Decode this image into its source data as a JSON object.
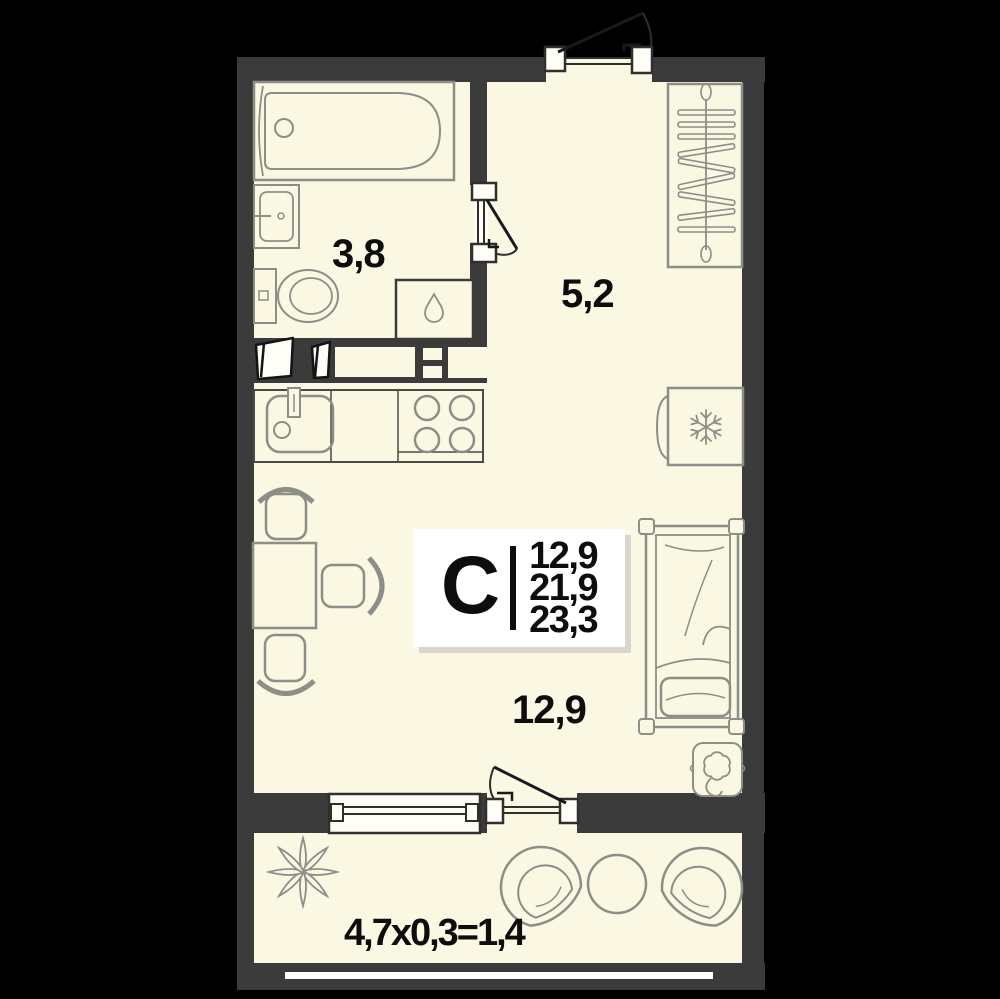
{
  "plan": {
    "card": {
      "type_letter": "С",
      "living_area": "12,9",
      "area_without_balcony": "21,9",
      "total_area": "23,3"
    },
    "room_areas": {
      "bathroom": "3,8",
      "hall": "5,2",
      "living": "12,9"
    },
    "balcony_formula": "4,7x0,3=1,4"
  },
  "icons": {
    "fridge_badge": "snowflake",
    "washer_badge": "water-drop",
    "wardrobe_badge": "hanger-rod"
  },
  "colors": {
    "background": "#000000",
    "wall": "#3B3B3B",
    "floor": "#FAF7E3",
    "furniture_stroke": "#8E8E89",
    "dark_stroke": "#2F2F2C",
    "text": "#0D0D0D",
    "card_bg": "#FFFFFF",
    "card_shadow": "#D8D6CD"
  }
}
